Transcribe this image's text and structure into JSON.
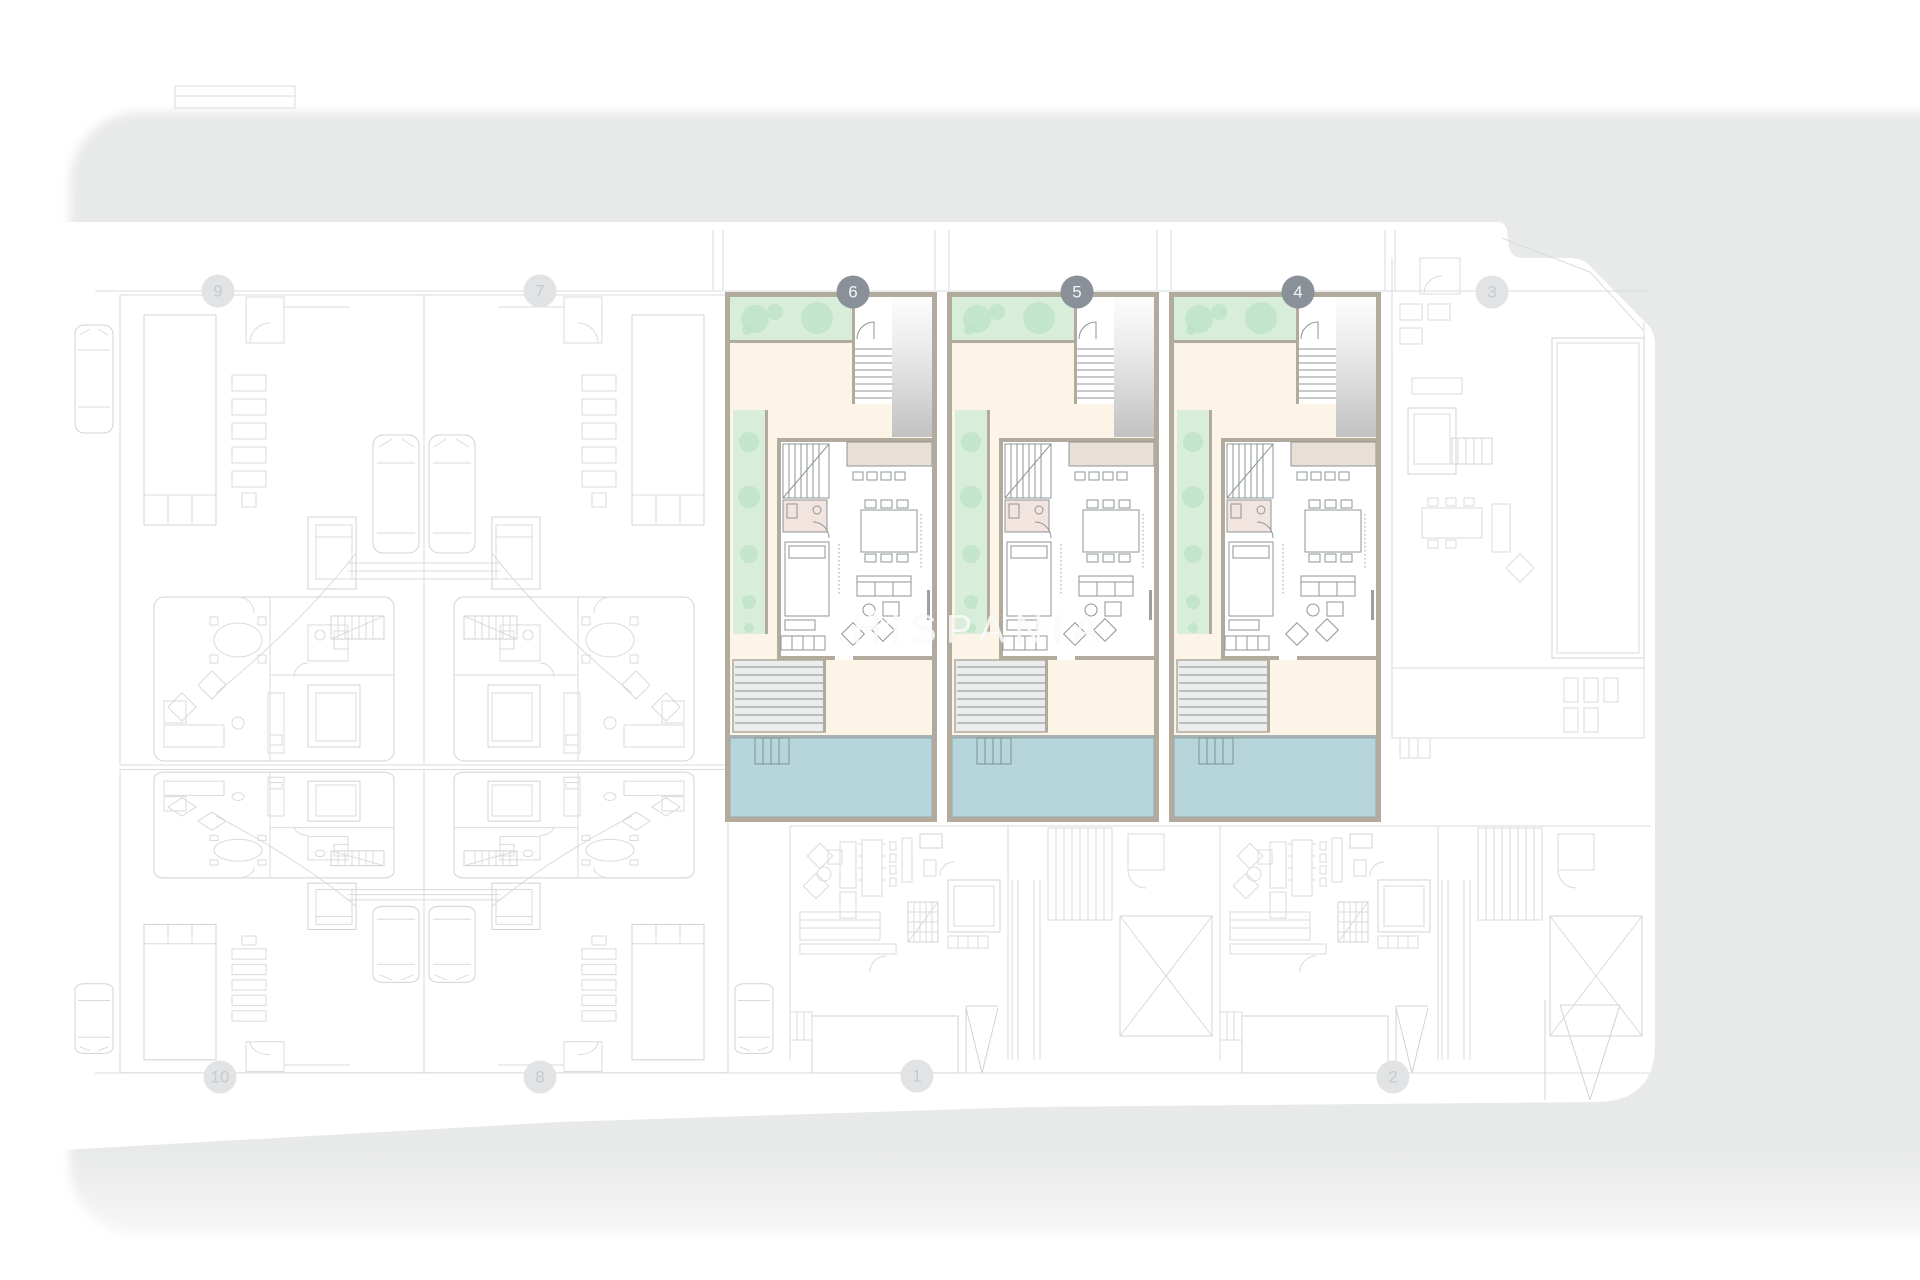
{
  "plan": {
    "type": "residential-site-plan",
    "floor_shown": "ground-floor",
    "highlighted_unit_numbers": [
      "6",
      "5",
      "4"
    ],
    "faded_unit_numbers": [
      "9",
      "7",
      "3",
      "10",
      "8",
      "1",
      "2"
    ]
  },
  "watermark": {
    "text": "HISPANIA",
    "logo": "mountain-logo"
  },
  "badges": [
    {
      "label": "9",
      "state": "faded"
    },
    {
      "label": "7",
      "state": "faded"
    },
    {
      "label": "6",
      "state": "active"
    },
    {
      "label": "5",
      "state": "active"
    },
    {
      "label": "4",
      "state": "active"
    },
    {
      "label": "3",
      "state": "faded"
    },
    {
      "label": "10",
      "state": "faded"
    },
    {
      "label": "8",
      "state": "faded"
    },
    {
      "label": "1",
      "state": "faded"
    },
    {
      "label": "2",
      "state": "faded"
    }
  ],
  "colors": {
    "street_gray": "#e8e9e9",
    "plot_white": "#ffffff",
    "wall_taupe": "#b1aa9d",
    "interior_cream": "#fcf4e6",
    "garden_green": "#d8edda",
    "tree_green": "#bfe3c7",
    "pool_blue": "#b6d6db",
    "deck_gray": "#ebedec",
    "faint_line": "#d8dbde",
    "badge_active_bg": "#8a9097",
    "badge_active_text": "#f4f5f6",
    "badge_faded_bg": "#e2e3e5",
    "badge_faded_text": "#c7c9cb"
  }
}
